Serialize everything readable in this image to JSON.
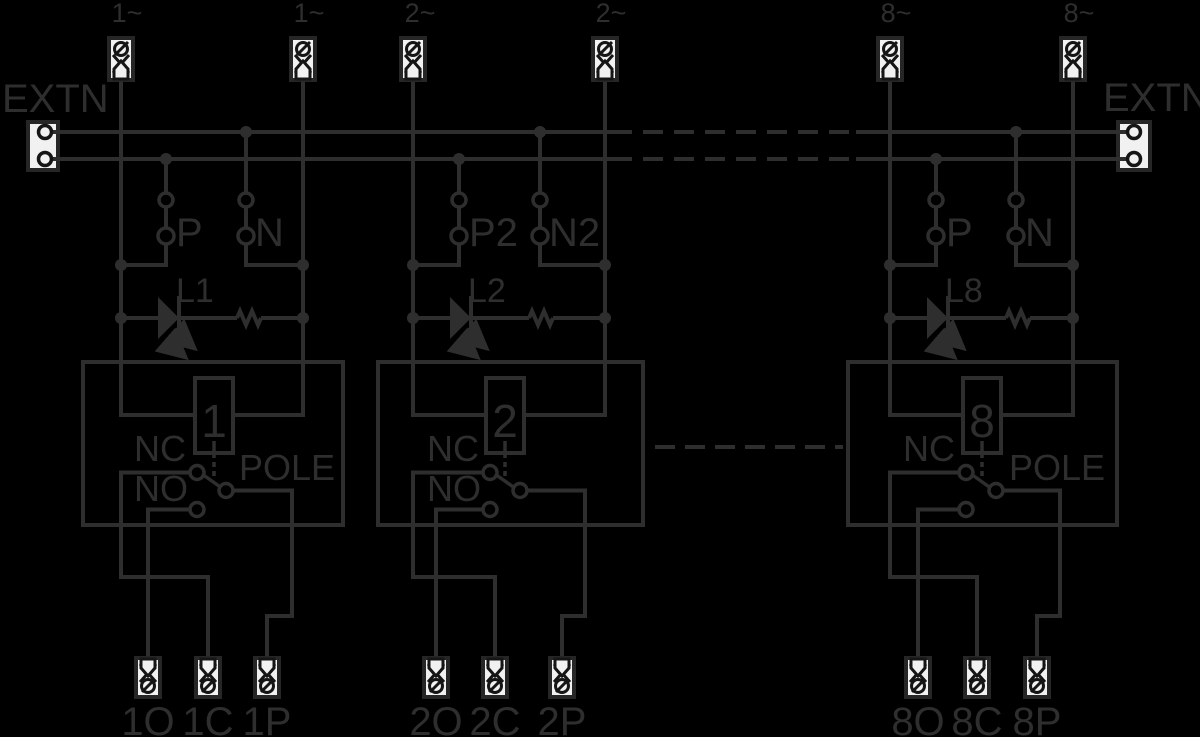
{
  "colors": {
    "background": "#000000",
    "line": "#2e2e2e",
    "terminal_fill": "#f1f1f1",
    "terminal_glyph": "#151515"
  },
  "extn_left": "EXTN",
  "extn_right": "EXTN",
  "blocks": [
    {
      "top_terminals": [
        "1~",
        "1~"
      ],
      "phase_label": "P",
      "neutral_label": "N",
      "led_label": "L1",
      "coil_number": "1",
      "nc_label": "NC",
      "no_label": "NO",
      "pole_label": "POLE",
      "bottom_terminals": [
        "1O",
        "1C",
        "1P"
      ]
    },
    {
      "top_terminals": [
        "2~",
        "2~"
      ],
      "phase_label": "P2",
      "neutral_label": "N2",
      "led_label": "L2",
      "coil_number": "2",
      "nc_label": "NC",
      "no_label": "NO",
      "bottom_terminals": [
        "2O",
        "2C",
        "2P"
      ]
    },
    {
      "top_terminals": [
        "8~",
        "8~"
      ],
      "phase_label": "P",
      "neutral_label": "N",
      "led_label": "L8",
      "coil_number": "8",
      "nc_label": "NC",
      "pole_label": "POLE",
      "bottom_terminals": [
        "8O",
        "8C",
        "8P"
      ]
    }
  ]
}
